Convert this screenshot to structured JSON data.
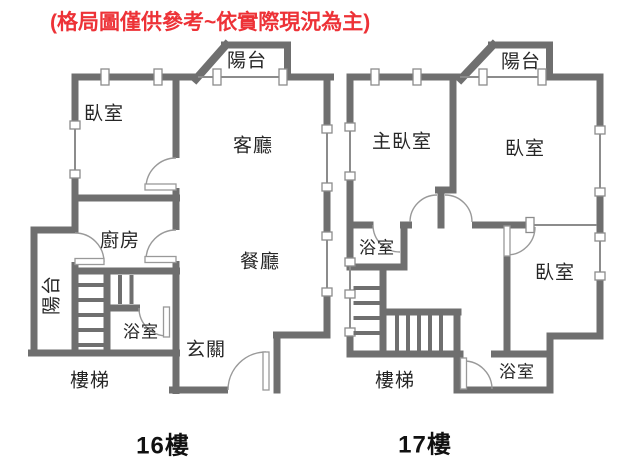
{
  "title": "(格局圖僅供參考~依實際現況為主)",
  "colors": {
    "wall": "#6f6f6f",
    "window": "#8c8c8c",
    "door_arc": "#999999",
    "label": "#262626",
    "floor_caption": "#111111",
    "disclaimer": "#ed3237"
  },
  "floors": [
    {
      "name": "16樓",
      "rooms": {
        "balcony_top": "陽台",
        "bedroom": "臥室",
        "living": "客廳",
        "kitchen": "廚房",
        "dining": "餐廳",
        "balcony_side": "陽台",
        "bathroom": "浴室",
        "foyer": "玄關",
        "stairs": "樓梯"
      }
    },
    {
      "name": "17樓",
      "rooms": {
        "balcony_top": "陽台",
        "master_bedroom": "主臥室",
        "bedroom_top": "臥室",
        "bathroom_mid": "浴室",
        "bedroom_right": "臥室",
        "bathroom_bottom": "浴室",
        "stairs": "樓梯"
      }
    }
  ]
}
